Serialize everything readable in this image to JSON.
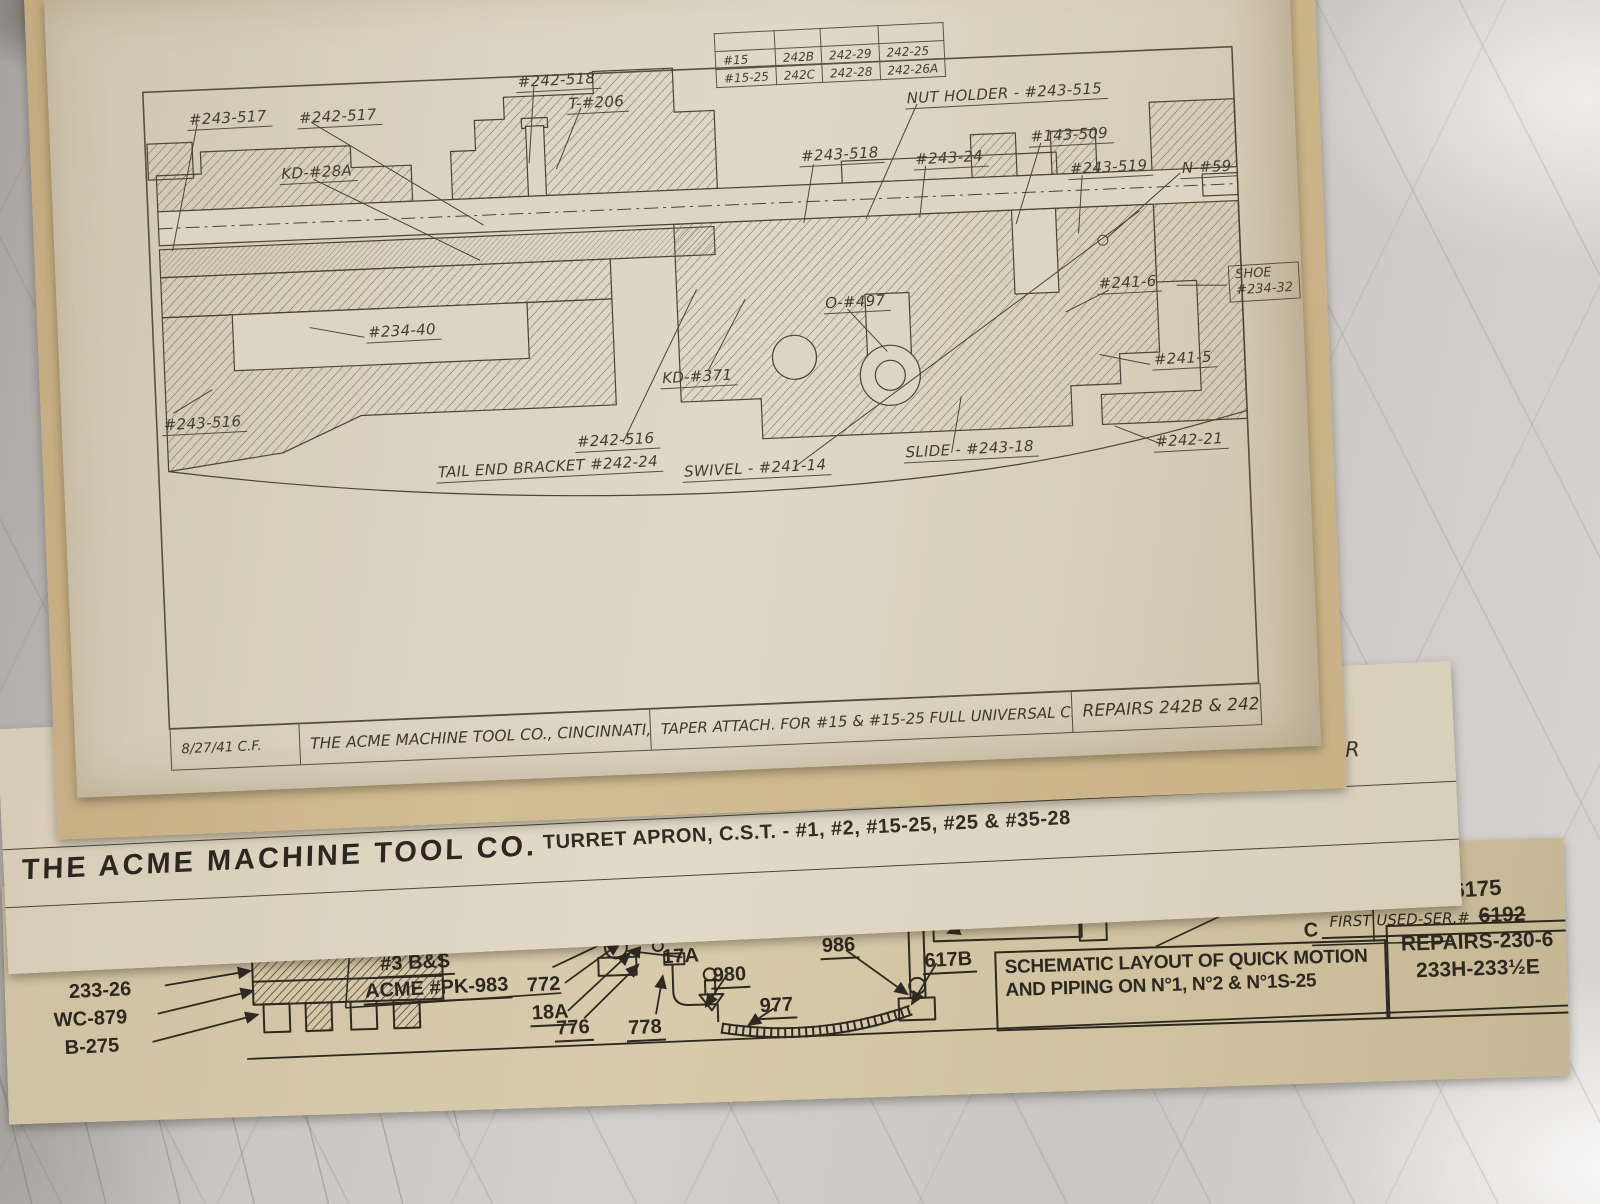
{
  "sheet1": {
    "parts_table": {
      "headers": [
        "MACHINE",
        "GROUP",
        "SADDLE",
        "TURRET SLIDE"
      ],
      "rows": [
        [
          "#15",
          "242B",
          "242-29",
          "242-25"
        ],
        [
          "#15-25",
          "242C",
          "242-28",
          "242-26A"
        ]
      ]
    },
    "labels": [
      {
        "text": "#243-517",
        "x": 138,
        "y": 118
      },
      {
        "text": "#242-517",
        "x": 248,
        "y": 121
      },
      {
        "text": "#242-518",
        "x": 468,
        "y": 94
      },
      {
        "text": "T-#206",
        "x": 518,
        "y": 118
      },
      {
        "text": "KD-#28A",
        "x": 228,
        "y": 176
      },
      {
        "text": "NUT HOLDER - #243-515",
        "x": 856,
        "y": 126
      },
      {
        "text": "#243-518",
        "x": 748,
        "y": 180
      },
      {
        "text": "#243-24",
        "x": 862,
        "y": 188
      },
      {
        "text": "#143-509",
        "x": 978,
        "y": 170
      },
      {
        "text": "#243-519",
        "x": 1016,
        "y": 204
      },
      {
        "text": "N-#59",
        "x": 1128,
        "y": 208
      },
      {
        "text": "#241-6",
        "x": 1040,
        "y": 320
      },
      {
        "text": "O-#497",
        "x": 766,
        "y": 328
      },
      {
        "text": "#234-40",
        "x": 308,
        "y": 338
      },
      {
        "text": "KD-#371",
        "x": 600,
        "y": 396
      },
      {
        "text": "#241-5",
        "x": 1092,
        "y": 398
      },
      {
        "text": "#243-516",
        "x": 100,
        "y": 422
      },
      {
        "text": "#242-516",
        "x": 512,
        "y": 456
      },
      {
        "text": "TAIL END BRACKET #242-24",
        "x": 372,
        "y": 480
      },
      {
        "text": "SWIVEL - #241-14",
        "x": 618,
        "y": 490
      },
      {
        "text": "SLIDE - #243-18",
        "x": 840,
        "y": 480
      },
      {
        "text": "#242-21",
        "x": 1090,
        "y": 480
      }
    ],
    "shoe_label": {
      "line1": "SHOE",
      "line2": "#234-32"
    },
    "title_strip": {
      "date": "8/27/41 C.F.",
      "company": "THE ACME MACHINE TOOL CO., CINCINNATI, OHIO",
      "description": "TAPER ATTACH. FOR #15 & #15-25 FULL UNIVERSAL CROSS SLIDING TURRET",
      "repairs": "REPAIRS 242B & 242C"
    }
  },
  "sheet2": {
    "friction_plate": "FRICTION PLATE",
    "company": "THE ACME MACHINE TOOL CO.",
    "title": "TURRET APRON, C.S.T. - #1, #2, #15-25, #25 & #35-28",
    "repairs": "REPAIRS 255R"
  },
  "sheet3": {
    "labels": [
      {
        "text": "233-26",
        "x": 62,
        "y": 96,
        "u": false
      },
      {
        "text": "WC-879",
        "x": 46,
        "y": 124,
        "u": false
      },
      {
        "text": "B-275",
        "x": 56,
        "y": 152,
        "u": false
      },
      {
        "text": "#3 B&S",
        "x": 374,
        "y": 78
      },
      {
        "text": "ACME #PK-983",
        "x": 358,
        "y": 104
      },
      {
        "text": "772",
        "x": 520,
        "y": 104,
        "u": false
      },
      {
        "text": "18A",
        "x": 524,
        "y": 132
      },
      {
        "text": "776",
        "x": 548,
        "y": 148
      },
      {
        "text": "778",
        "x": 620,
        "y": 150
      },
      {
        "text": "17A",
        "x": 656,
        "y": 80,
        "u": false
      },
      {
        "text": "980",
        "x": 706,
        "y": 100
      },
      {
        "text": "977",
        "x": 752,
        "y": 132
      },
      {
        "text": "986",
        "x": 816,
        "y": 74
      },
      {
        "text": "617B",
        "x": 918,
        "y": 92
      },
      {
        "text": "734A",
        "x": 1014,
        "y": 44
      },
      {
        "text": "B",
        "x": 1256,
        "y": 48,
        "u": false
      },
      {
        "text": "C",
        "x": 1298,
        "y": 74,
        "u": false
      }
    ],
    "first_used_label": "FIRST USED-SER.#",
    "serial_crossed": "6192",
    "serial_new": "6175",
    "schematic_box": {
      "line1": "SCHEMATIC LAYOUT OF QUICK MOTION",
      "line2": "AND PIPING ON  N°1, N°2 & N°1S-25"
    },
    "repairs_box": {
      "line1": "REPAIRS-230-6",
      "line2": "233H-233½E"
    }
  }
}
